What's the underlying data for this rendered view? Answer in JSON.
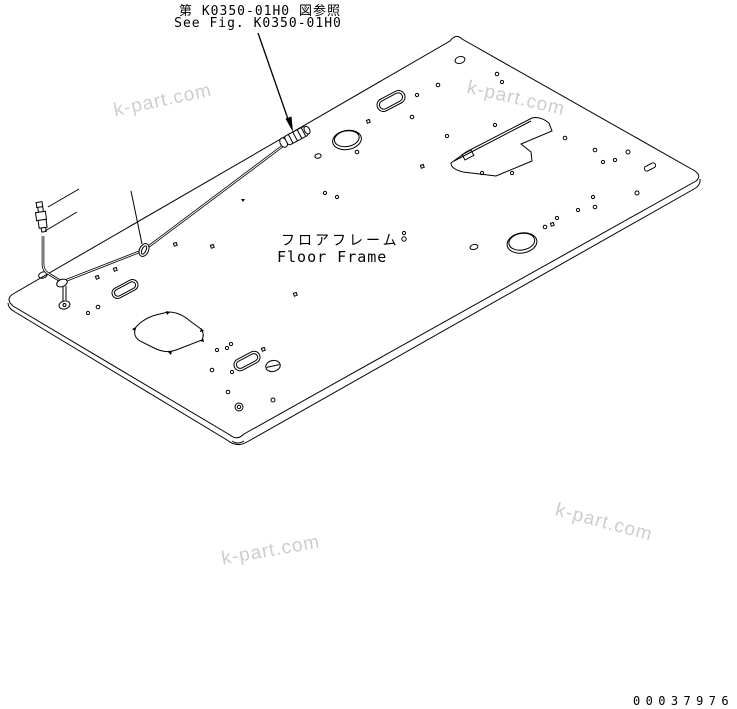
{
  "figure_reference": {
    "line_jp": "第 K0350-01H0 図参照",
    "line_en": "See Fig. K0350-01H0"
  },
  "part_label": {
    "jp": "フロアフレーム",
    "en": "Floor Frame"
  },
  "footer": {
    "drawing_number": "00037976"
  },
  "watermark": {
    "text": "k-part.com",
    "color": "#c5c5c5"
  },
  "colors": {
    "line": "#000000",
    "background": "#ffffff"
  }
}
